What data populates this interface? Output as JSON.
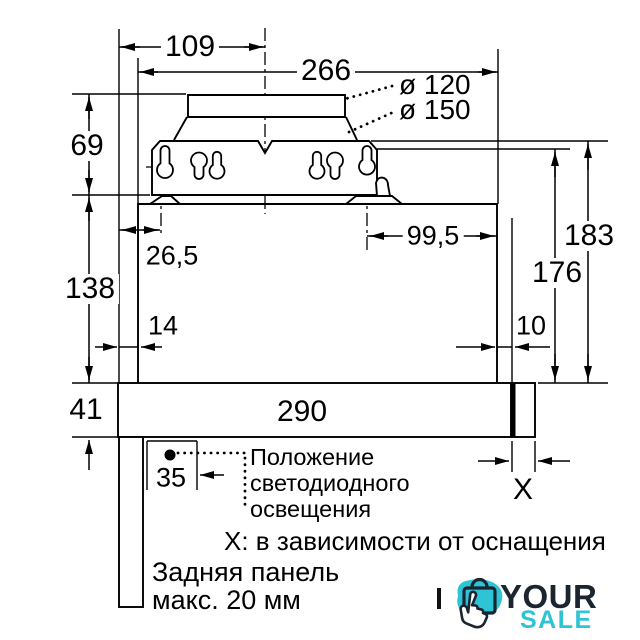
{
  "title": "Чертёж установки вытяжки (размеры в мм)",
  "dimensions": {
    "d109": "109",
    "d266": "266",
    "dia120": "ø 120",
    "dia150": "ø 150",
    "d69": "69",
    "d138": "138",
    "d41": "41",
    "d26_5": "26,5",
    "d99_5": "99,5",
    "d14": "14",
    "d10": "10",
    "d290": "290",
    "d183": "183",
    "d176": "176",
    "d35": "35",
    "dX": "X"
  },
  "annotations": {
    "led_position_line1": "Положение",
    "led_position_line2": "светодиодного",
    "led_position_line3": "освещения",
    "x_note": "X: в зависимости от оснащения",
    "back_panel_line1": "Задняя панель",
    "back_panel_line2": "макс. 20 мм"
  },
  "logo": {
    "word_top": "YOUR",
    "word_bottom": "SALE",
    "teal": "#2fc3d6",
    "navy": "#1b2530",
    "icon": "shopping-bag-click-hand"
  },
  "colors": {
    "line": "#000000",
    "background": "#ffffff"
  }
}
